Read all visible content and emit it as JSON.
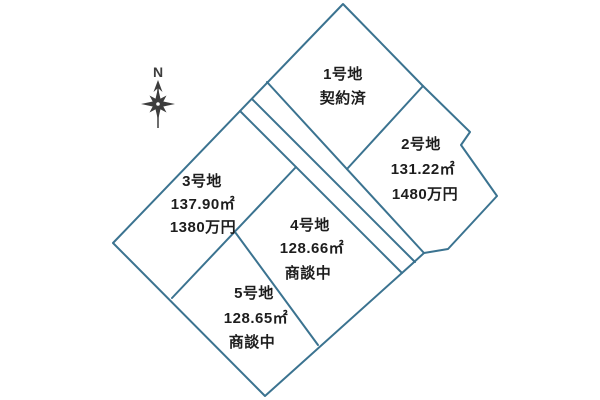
{
  "map": {
    "background_color": "#ffffff",
    "outline_color": "#3b7390",
    "text_color": "#1d1d1d",
    "compass": {
      "north_label": "N"
    },
    "lots": [
      {
        "name": "1号地",
        "status": "契約済"
      },
      {
        "name": "2号地",
        "area": "131.22㎡",
        "price": "1480万円"
      },
      {
        "name": "3号地",
        "area": "137.90㎡",
        "price": "1380万円"
      },
      {
        "name": "4号地",
        "area": "128.66㎡",
        "status": "商談中"
      },
      {
        "name": "5号地",
        "area": "128.65㎡",
        "status": "商談中"
      }
    ]
  }
}
